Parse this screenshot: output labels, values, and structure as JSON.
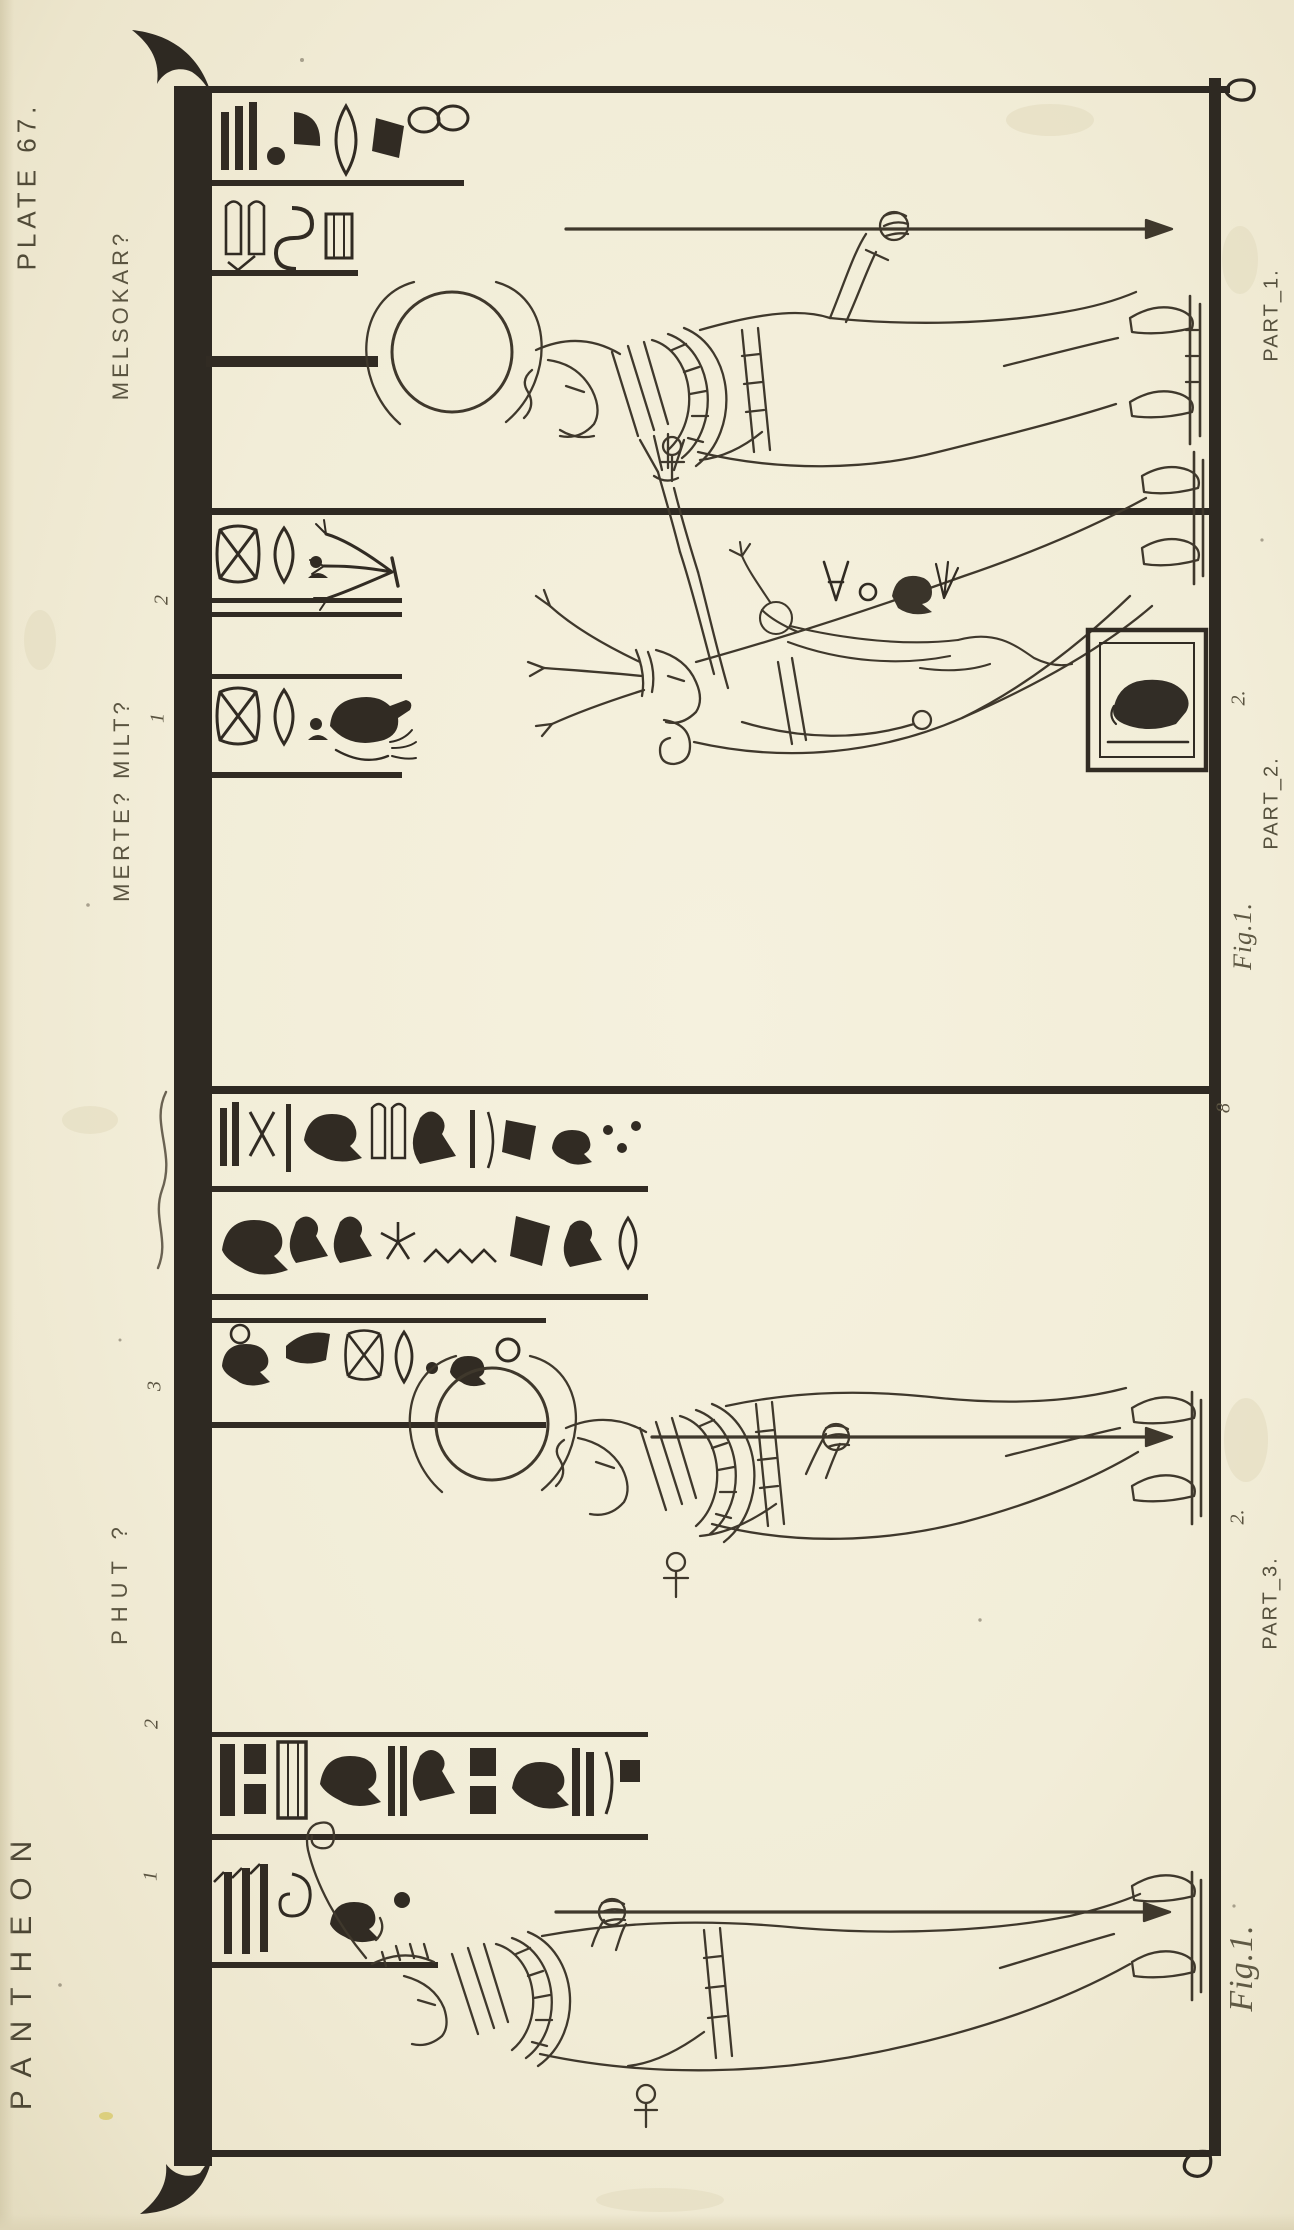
{
  "palette": {
    "paper": "#f2edd8",
    "ink": "#2e2922",
    "line_ink": "#3f382c",
    "label_ink": "#57513d"
  },
  "margins": {
    "plate_label": "PLATE 67.",
    "work_title": "PANTHEON"
  },
  "deity_names": {
    "panel1": "MELSOKAR?",
    "panel2": "MERTE? MILT?",
    "panel3": "PHUT ?"
  },
  "part_labels": {
    "part1": "PART_1.",
    "part2": "PART_2.",
    "part3": "PART_3."
  },
  "figure_labels": {
    "part2_figure": "Fig.1.",
    "part3_figure": "Fig.1."
  },
  "reference_numbers": {
    "panel2_row_upper": "2",
    "panel2_row_lower": "1",
    "panel2_scene": "2.",
    "panel3_marker": "8",
    "panel3_row": "3",
    "panel3_scene": "2.",
    "panel4_row_upper": "2",
    "panel4_row_lower": "1"
  }
}
